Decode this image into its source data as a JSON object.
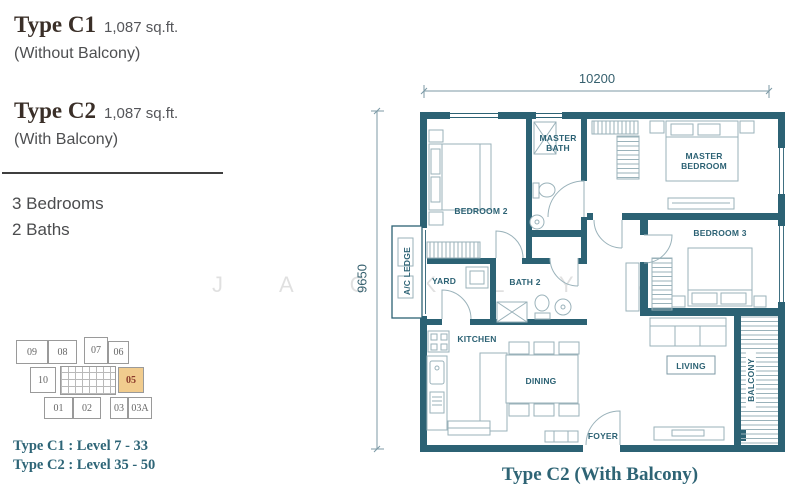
{
  "left_panel": {
    "type_c1_title": "Type C1",
    "type_c1_area": "1,087 sq.ft.",
    "type_c1_subtitle": "(Without Balcony)",
    "type_c2_title": "Type C2",
    "type_c2_area": "1,087 sq.ft.",
    "type_c2_subtitle": "(With Balcony)",
    "bedrooms": "3 Bedrooms",
    "baths": "2 Baths",
    "level_c1": "Type C1 : Level 7 - 33",
    "level_c2": "Type C2 : Level 35 - 50"
  },
  "key_plan": {
    "units": {
      "u09": "09",
      "u08": "08",
      "u07": "07",
      "u06": "06",
      "u10": "10",
      "u05": "05",
      "u01": "01",
      "u02": "02",
      "u03": "03",
      "u03a": "03A"
    },
    "highlighted_unit": "05",
    "highlight_color": "#f1cc8e",
    "highlight_text_color": "#8b3a2b"
  },
  "watermark": "JACKLYN",
  "floor_plan": {
    "caption": "Type C2 (With Balcony)",
    "dim_width": "10200",
    "dim_height": "9650",
    "rooms": {
      "bedroom2": "BEDROOM 2",
      "master_bath": "MASTER BATH",
      "master_bedroom": "MASTER BEDROOM",
      "bedroom3": "BEDROOM 3",
      "ac_ledge": "A/C LEDGE",
      "yard": "YARD",
      "bath2": "BATH 2",
      "kitchen": "KITCHEN",
      "dining": "DINING",
      "living": "LIVING",
      "foyer": "FOYER",
      "balcony": "BALCONY"
    },
    "colors": {
      "wall": "#2c6274",
      "furniture": "#9ab2ba",
      "label": "#2c6274"
    }
  }
}
